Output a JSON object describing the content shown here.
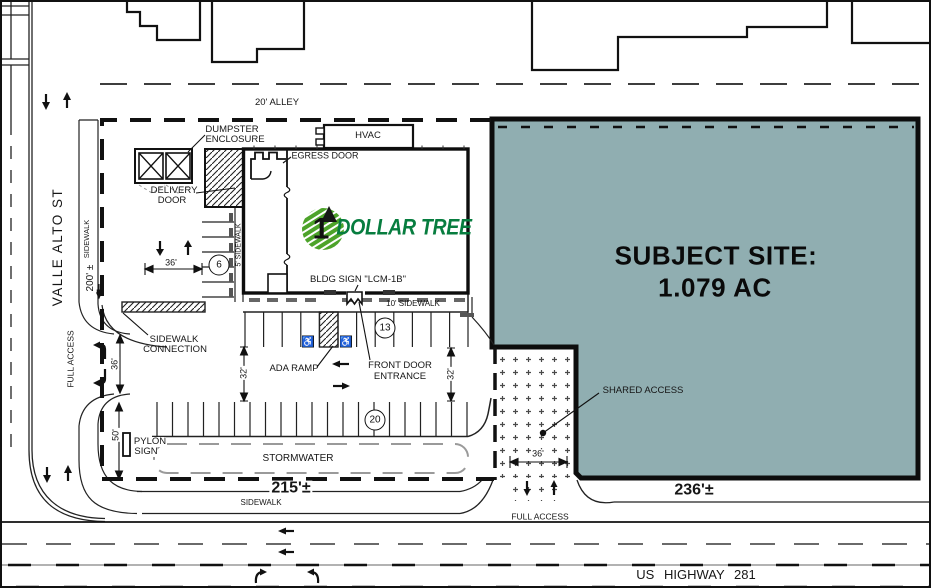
{
  "colors": {
    "site_fill": "#90AEB1",
    "brand_green": "#077D3F",
    "stripe_green": "#4DA32A"
  },
  "icons": {
    "ada_symbol": "♿",
    "brand_number": "1"
  },
  "alley": {
    "label": "20' ALLEY"
  },
  "streets": {
    "valle_alto": "VALLE ALTO ST",
    "highway": "US HIGHWAY 281",
    "sidewalk_left": "SIDEWALK",
    "sidewalk_bottom": "SIDEWALK"
  },
  "access": {
    "full_access_left": "FULL ACCESS",
    "full_access_bottom": "FULL ACCESS",
    "shared_access": "SHARED ACCESS"
  },
  "building": {
    "brand_name": "DOLLAR TREE",
    "hvac": "HVAC",
    "egress_door": "EGRESS DOOR",
    "dumpster_line1": "DUMPSTER",
    "dumpster_line2": "ENCLOSURE",
    "delivery_line1": "DELIVERY",
    "delivery_line2": "DOOR",
    "bldg_sign": "BLDG SIGN \"LCM-1B\"",
    "sidewalk_5": "5' SIDEWALK",
    "sidewalk_10": "10' SIDEWALK"
  },
  "site": {
    "title_line1": "SUBJECT SITE:",
    "title_line2": "1.079 AC"
  },
  "parking": {
    "count_west": "6",
    "count_front": "13",
    "count_south": "20",
    "ada_ramp": "ADA RAMP",
    "front_door_line1": "FRONT DOOR",
    "front_door_line2": "ENTRANCE",
    "sidewalk_conn_line1": "SIDEWALK",
    "sidewalk_conn_line2": "CONNECTION",
    "pylon_line1": "PYLON",
    "pylon_line2": "SIGN",
    "stormwater": "STORMWATER"
  },
  "dimensions": {
    "frontage_west": "200' ±",
    "frontage_south": "215'±",
    "frontage_site": "236'±",
    "drive_west": "36'",
    "aisle_west": "36'",
    "drive_shared": "36'",
    "aisle_a": "32'",
    "aisle_b": "32'",
    "setback_south": "50'"
  }
}
